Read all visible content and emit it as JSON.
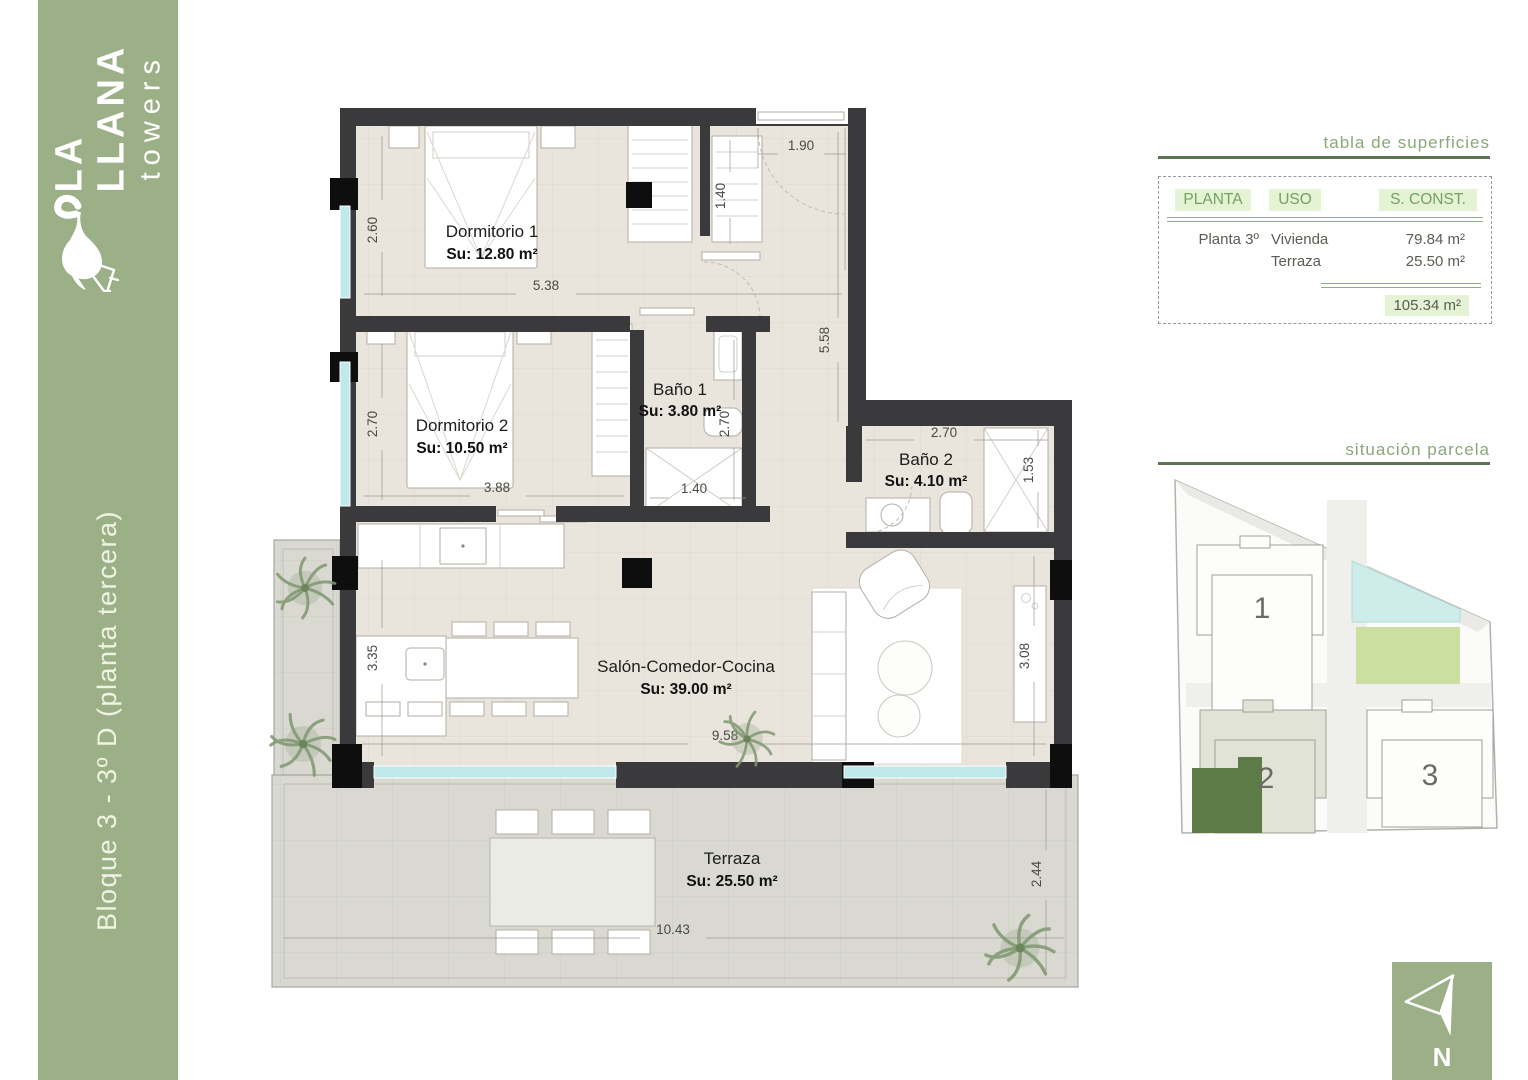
{
  "branding": {
    "logo_line1": "LA",
    "logo_line2": "LLANA",
    "logo_line3": "towers",
    "plan_title": "Bloque 3 - 3º D (planta tercera)"
  },
  "surface_table": {
    "title": "tabla de superficies",
    "headers": [
      "PLANTA",
      "USO",
      "S. CONST."
    ],
    "rows": [
      {
        "planta": "Planta 3º",
        "uso": "Vivienda",
        "sconst": "79.84 m²"
      },
      {
        "planta": "",
        "uso": "Terraza",
        "sconst": "25.50 m²"
      }
    ],
    "total": "105.34 m²"
  },
  "rooms": [
    {
      "name": "Dormitorio 1",
      "area": "Su: 12.80 m²"
    },
    {
      "name": "Dormitorio 2",
      "area": "Su: 10.50 m²"
    },
    {
      "name": "Baño 1",
      "area": "Su: 3.80 m²"
    },
    {
      "name": "Baño 2",
      "area": "Su: 4.10 m²"
    },
    {
      "name": "Salón-Comedor-Cocina",
      "area": "Su: 39.00 m²"
    },
    {
      "name": "Terraza",
      "area": "Su: 25.50 m²"
    }
  ],
  "dims": {
    "dorm1_h": "2.60",
    "dorm1_w": "5.38",
    "entry_w": "1.90",
    "entry_closet": "1.40",
    "hall_h": "5.58",
    "dorm2_h": "2.70",
    "dorm2_w": "3.88",
    "bano1_h": "2.70",
    "bano1_w": "1.40",
    "bano2_w": "2.70",
    "bano2_d": "1.53",
    "kitchen_h": "3.35",
    "salon_w": "9.58",
    "salon_h": "3.08",
    "terraza_w": "10.43",
    "terraza_h": "2.44"
  },
  "site_plan": {
    "title": "situación parcela",
    "block1": "1",
    "block2": "2",
    "block3": "3"
  },
  "north": {
    "label": "N"
  },
  "colors": {
    "sidebar_green": "#9cb087",
    "heading_green": "#8ba878",
    "rule_green": "#5f7355",
    "table_highlight": "#e4f3d4",
    "table_line_green": "#8fae7e",
    "wall": "#3a3a3c",
    "window_glass": "#bfe9ea",
    "floor": "#e9e4dc",
    "terrace_floor": "#d9d9d1",
    "site_unit_green": "#5d7b46",
    "site_block2_fill": "#e0e3d6",
    "pool": "#cdecea",
    "lawn": "#cbdfa0"
  }
}
